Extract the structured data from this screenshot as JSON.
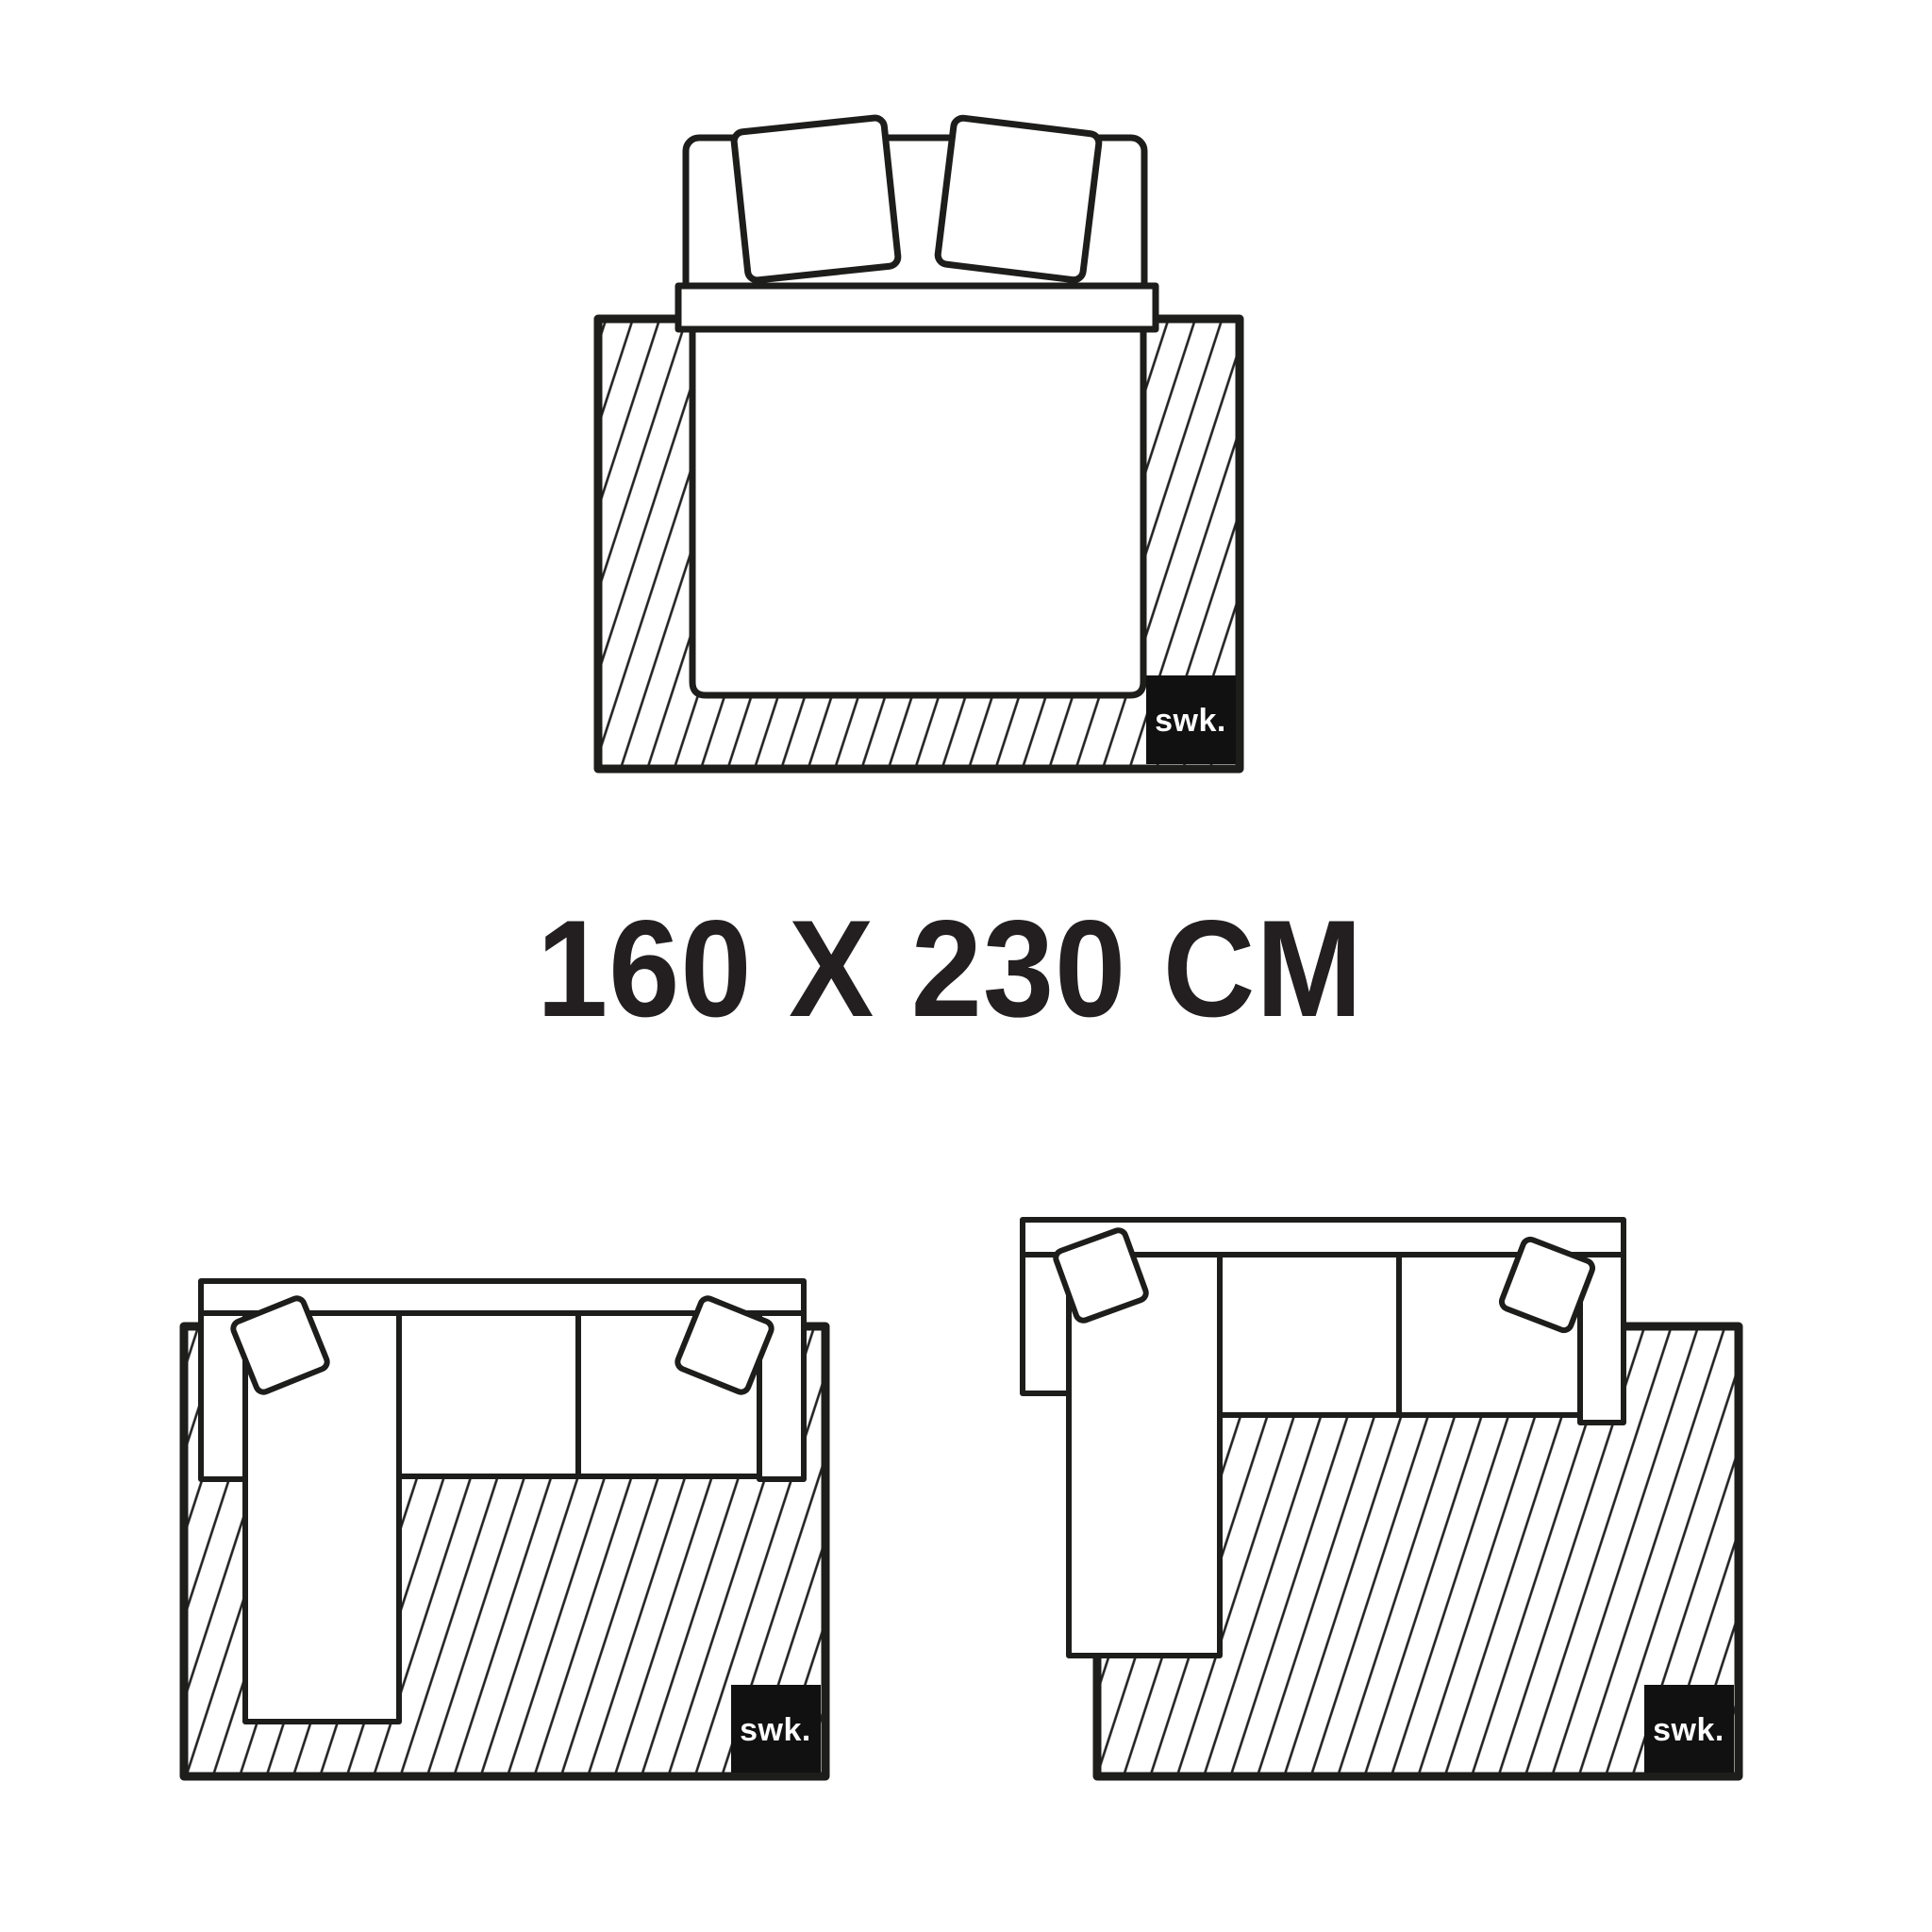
{
  "page": {
    "background": "#ffffff",
    "kind": "rug-size-guide-illustration"
  },
  "size_label": {
    "text": "160 X 230 CM",
    "color": "#231f20"
  },
  "brand": {
    "logo_text": "swk.",
    "box_color": "#111111",
    "text_color": "#ffffff"
  },
  "style": {
    "outline_color": "#1d1d1b",
    "hatch_color": "#222222",
    "fill_color": "#ffffff"
  },
  "diagrams": [
    {
      "id": "bed-on-rug",
      "description": "double bed with two pillows and duvet centered on rug, top view"
    },
    {
      "id": "sofa-left-on-rug",
      "description": "sectional sofa with left chaise fully on rug, top view"
    },
    {
      "id": "sofa-right-on-rug",
      "description": "sectional sofa with left chaise partly off rug, top view"
    }
  ]
}
